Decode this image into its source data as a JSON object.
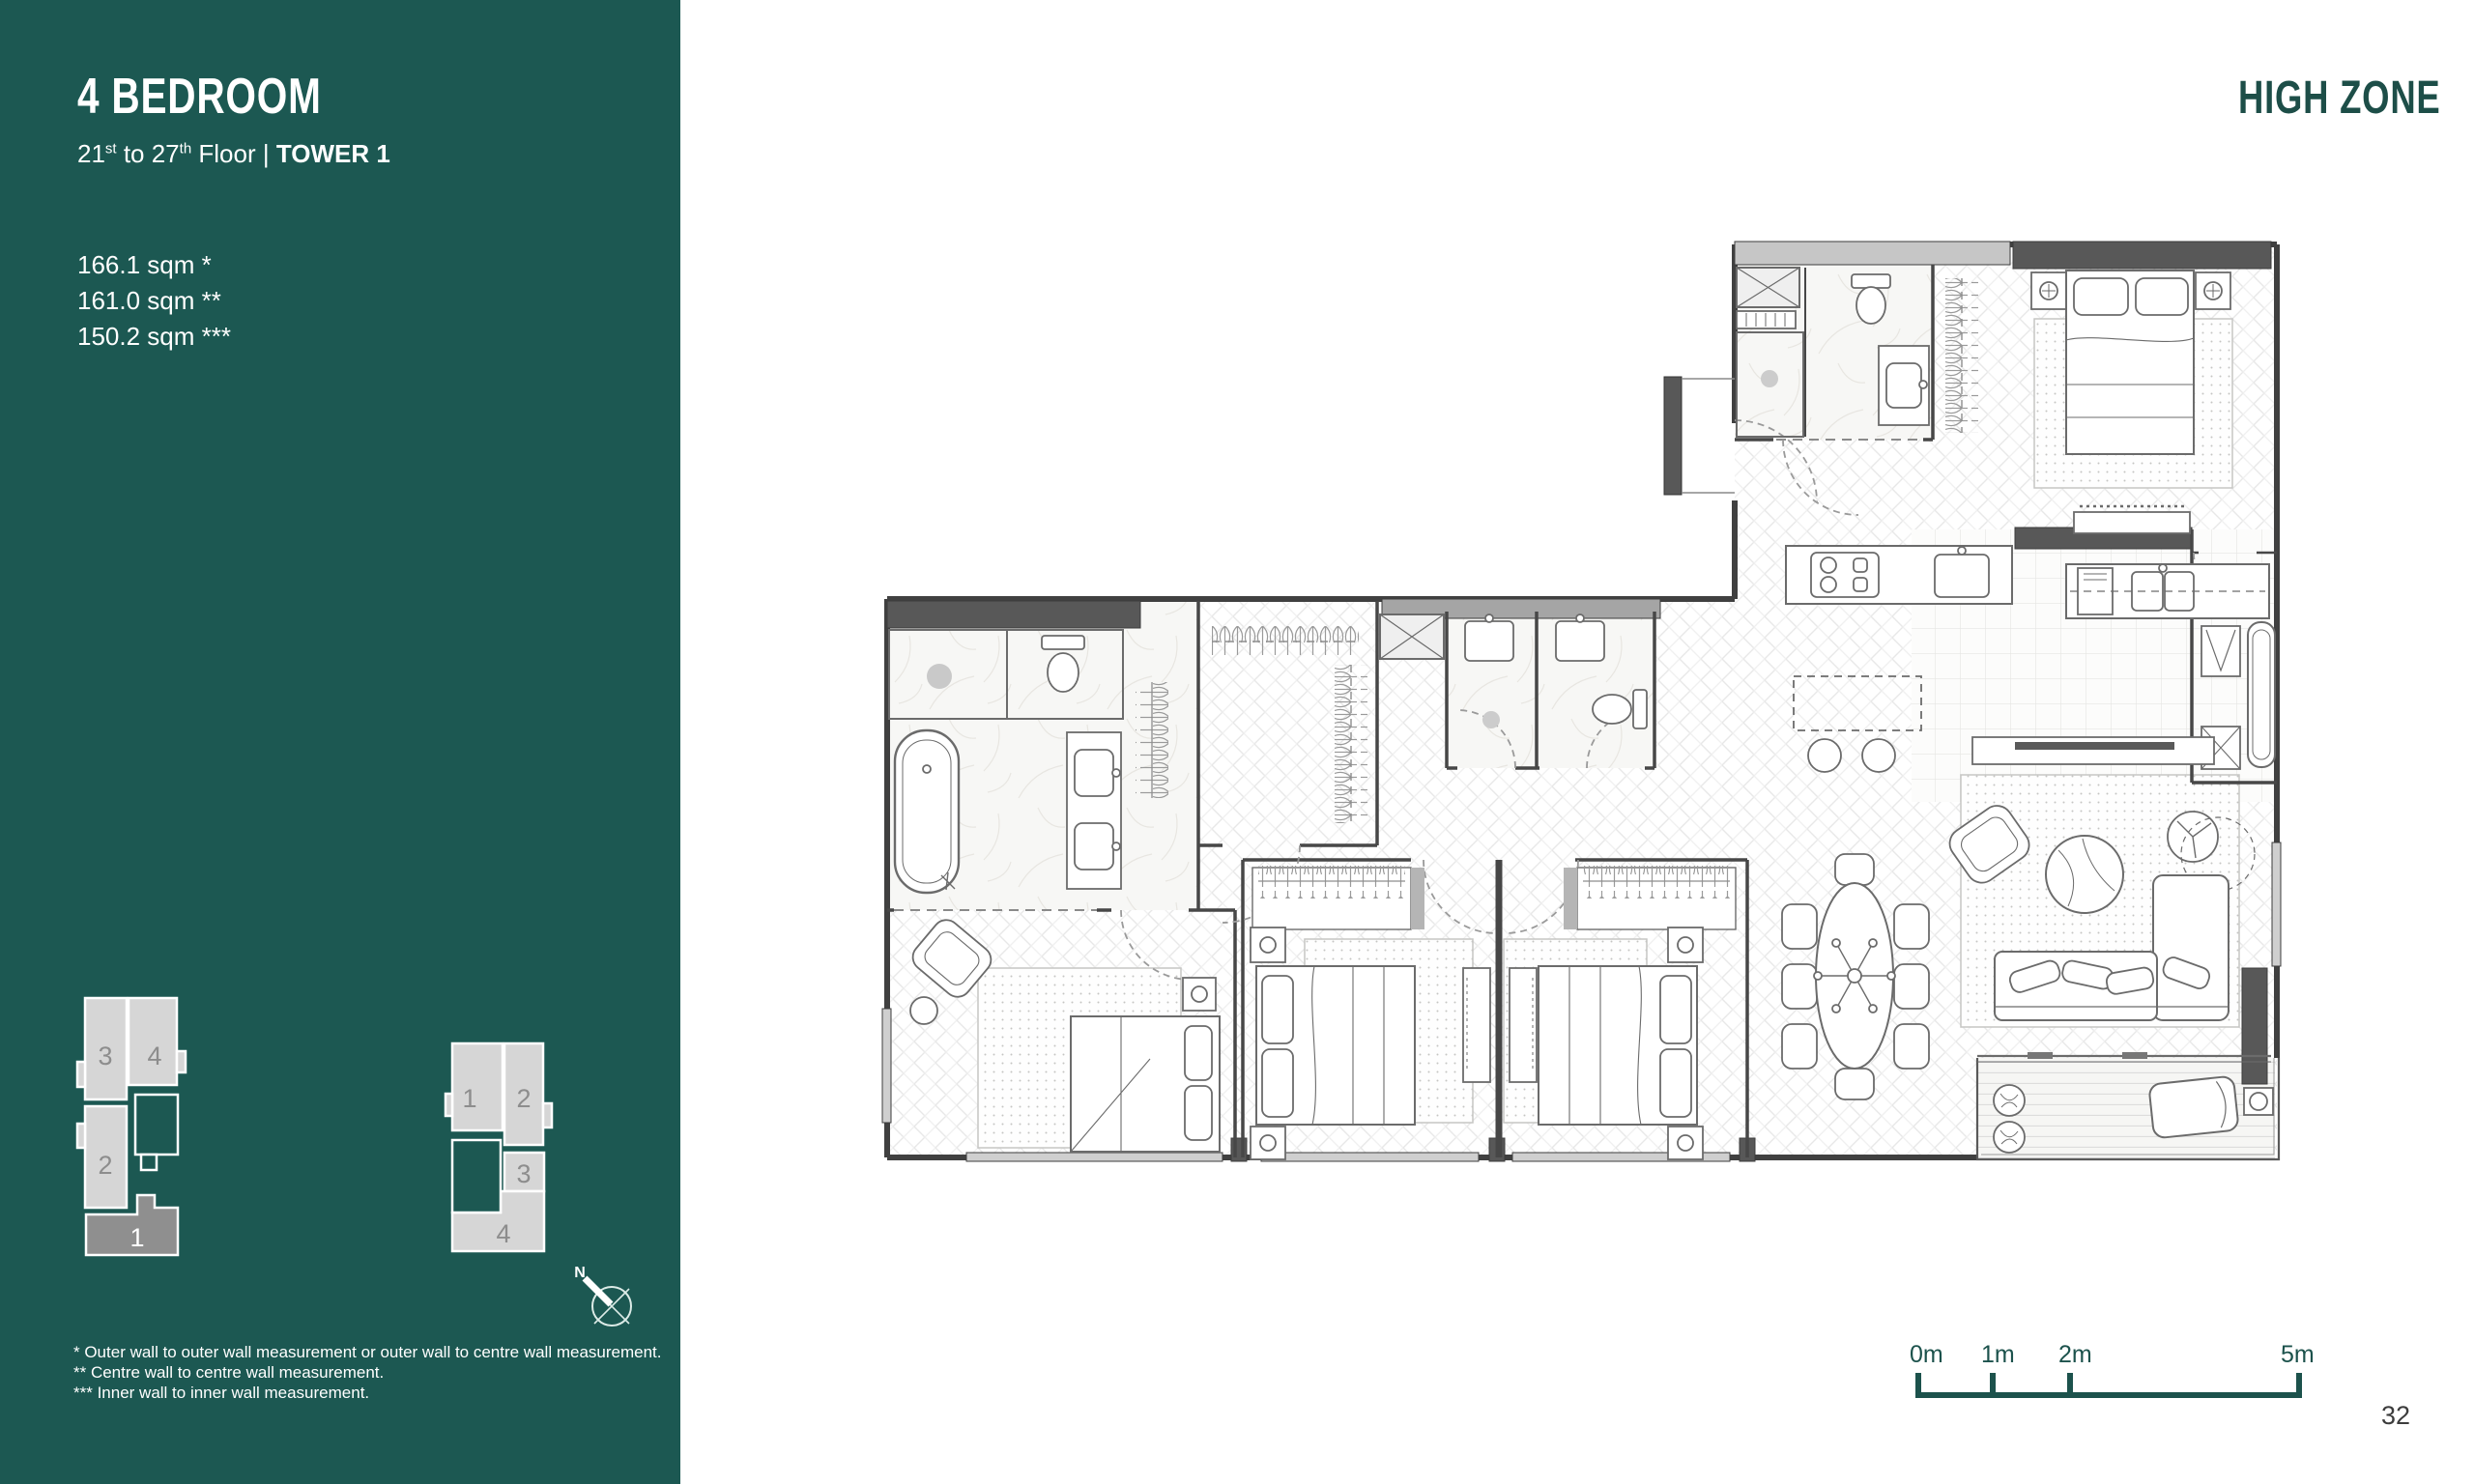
{
  "sidebar": {
    "title": "4 BEDROOM",
    "subtitle": {
      "floor_start": "21",
      "sup1": "st",
      "mid": " to 27",
      "sup2": "th",
      "tail": " Floor | ",
      "tower": "TOWER 1"
    },
    "areas": [
      "166.1 sqm *",
      "161.0 sqm **",
      "150.2 sqm ***"
    ],
    "footnotes": [
      "* Outer wall to outer wall measurement or  outer wall to centre wall measurement.",
      "** Centre wall to centre wall measurement.",
      "*** Inner wall to inner wall measurement."
    ],
    "keyplan_tower1": {
      "units": [
        "3",
        "4",
        "2",
        "1"
      ],
      "highlighted_unit": "1"
    },
    "keyplan_tower2": {
      "units": [
        "1",
        "2",
        "3",
        "4"
      ]
    },
    "compass_label": "N"
  },
  "header": {
    "zone_label": "HIGH ZONE"
  },
  "scale_bar": {
    "labels": [
      "0m",
      "1m",
      "2m",
      "5m"
    ]
  },
  "page_number": "32",
  "colors": {
    "panel_teal": "#1C5852",
    "accent_teal": "#1D4E48",
    "keyplan_unit_fill": "#D6D6D6",
    "keyplan_highlight_fill": "#8F8F8F",
    "wall_dark": "#585858",
    "wall_light": "#C6C6C6"
  }
}
